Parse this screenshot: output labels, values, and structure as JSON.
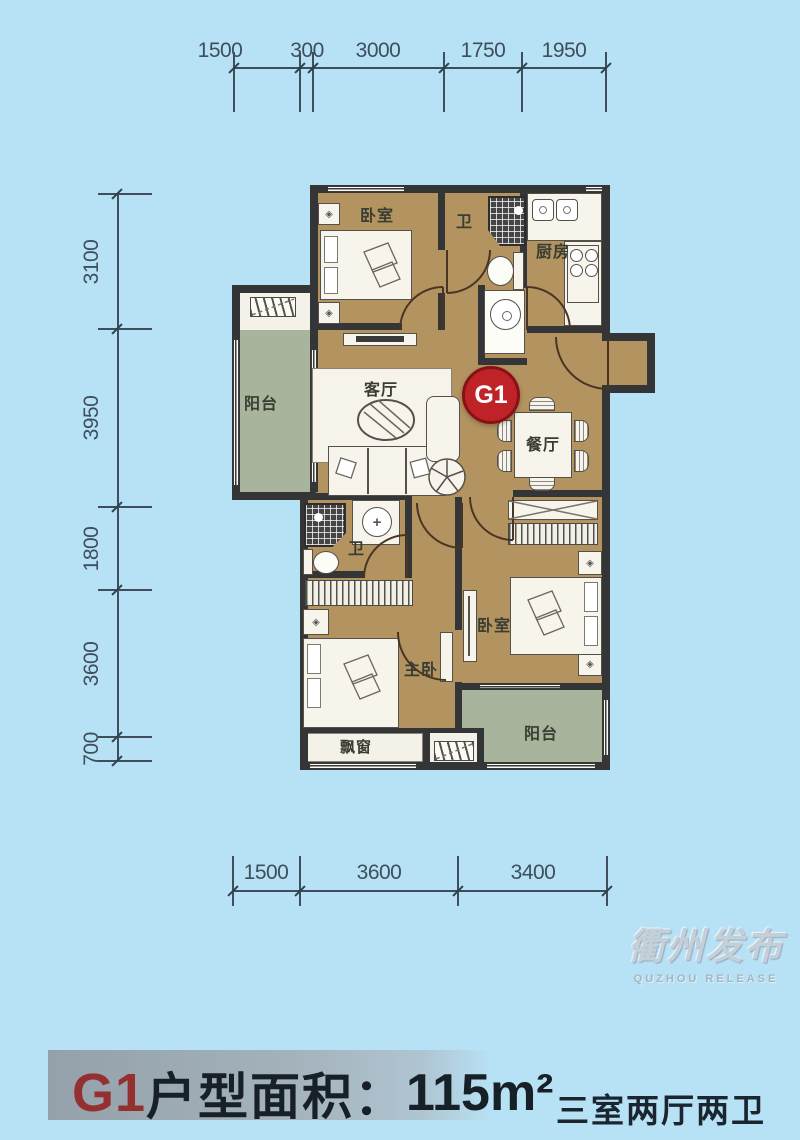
{
  "colors": {
    "background": "#b7e1f4",
    "floor_tan": "#b3935f",
    "balcony_green": "#a8b59c",
    "wall_dark": "#333536",
    "dimension_text": "#3e4e5c",
    "badge_red": "#bf2328",
    "footer_unit_red": "#94302f",
    "footer_text_navy": "#171f27",
    "watermark_grey": "#c5cfd9"
  },
  "dims": {
    "top": [
      "1500",
      "300",
      "3000",
      "1750",
      "1950"
    ],
    "left": [
      "3100",
      "3950",
      "1800",
      "3600",
      "700"
    ],
    "bottom": [
      "1500",
      "3600",
      "3400"
    ]
  },
  "rooms": {
    "bedroom_top": "卧室",
    "bath_top": "卫",
    "kitchen": "厨房",
    "balcony_left": "阳台",
    "living": "客厅",
    "dining": "餐厅",
    "bath_lower": "卫",
    "master_bedroom": "主卧",
    "bedroom_right": "卧室",
    "bay_window": "飘窗",
    "balcony_bottom": "阳台"
  },
  "badge": {
    "label": "G1"
  },
  "watermark": {
    "cn": "衢州发布",
    "en": "QUZHOU RELEASE"
  },
  "footer": {
    "unit": "G1",
    "area_label": "户型面积：",
    "area_value": "115m²",
    "layout_type": "三室两厅两卫"
  }
}
